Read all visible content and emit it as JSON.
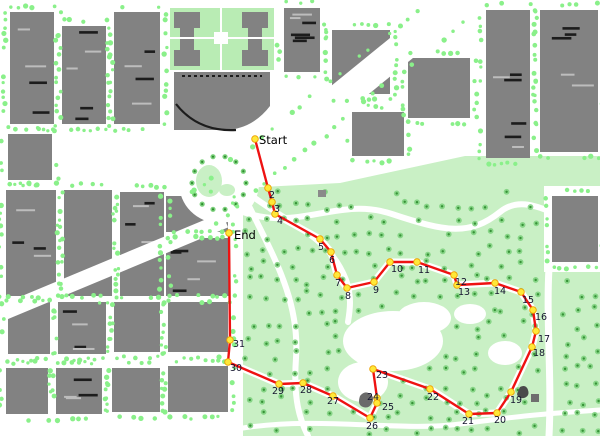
{
  "map": {
    "start_label": "Start",
    "end_label": "End",
    "colors": {
      "route": "#ee1212",
      "marker_fill": "#ffe838",
      "marker_stroke": "#eda000",
      "building": "#828282",
      "building_dark": "#1c1c1c",
      "roof_light": "#bdbdbd",
      "veg_dot": "#8af08a",
      "park": "#c9f0c5",
      "tree": "#7bd07b",
      "tree_core": "#2e8b2e",
      "road": "#ffffff",
      "label_color": "#14142e",
      "endpoint_label_color": "#000000"
    },
    "waypoints": [
      {
        "label": "Start",
        "x": 255,
        "y": 139,
        "dx": 4,
        "dy": 5,
        "big": true
      },
      {
        "label": "2",
        "x": 268,
        "y": 188,
        "dx": 1,
        "dy": 10
      },
      {
        "label": "3",
        "x": 272,
        "y": 202,
        "dx": 2,
        "dy": 10
      },
      {
        "label": "4",
        "x": 275,
        "y": 214,
        "dx": 2,
        "dy": 10
      },
      {
        "label": "5",
        "x": 320,
        "y": 239,
        "dx": -2,
        "dy": 11
      },
      {
        "label": "6",
        "x": 331,
        "y": 252,
        "dx": -2,
        "dy": 11
      },
      {
        "label": "7",
        "x": 337,
        "y": 275,
        "dx": -2,
        "dy": 11
      },
      {
        "label": "8",
        "x": 347,
        "y": 288,
        "dx": -2,
        "dy": 11
      },
      {
        "label": "9",
        "x": 374,
        "y": 282,
        "dx": -1,
        "dy": 11
      },
      {
        "label": "10",
        "x": 390,
        "y": 262,
        "dx": 1,
        "dy": 10
      },
      {
        "label": "11",
        "x": 417,
        "y": 262,
        "dx": 1,
        "dy": 11
      },
      {
        "label": "12",
        "x": 454,
        "y": 275,
        "dx": 1,
        "dy": 10
      },
      {
        "label": "13",
        "x": 457,
        "y": 285,
        "dx": 1,
        "dy": 10
      },
      {
        "label": "14",
        "x": 495,
        "y": 283,
        "dx": -1,
        "dy": 11
      },
      {
        "label": "15",
        "x": 521,
        "y": 292,
        "dx": 1,
        "dy": 11
      },
      {
        "label": "16",
        "x": 533,
        "y": 310,
        "dx": 2,
        "dy": 10
      },
      {
        "label": "17",
        "x": 536,
        "y": 331,
        "dx": 2,
        "dy": 11
      },
      {
        "label": "18",
        "x": 532,
        "y": 347,
        "dx": 1,
        "dy": 9
      },
      {
        "label": "19",
        "x": 511,
        "y": 392,
        "dx": -1,
        "dy": 11
      },
      {
        "label": "20",
        "x": 497,
        "y": 413,
        "dx": -3,
        "dy": 10
      },
      {
        "label": "21",
        "x": 469,
        "y": 414,
        "dx": -7,
        "dy": 10
      },
      {
        "label": "22",
        "x": 430,
        "y": 389,
        "dx": -3,
        "dy": 11
      },
      {
        "label": "23",
        "x": 373,
        "y": 369,
        "dx": 3,
        "dy": 9
      },
      {
        "label": "24",
        "x": 377,
        "y": 398,
        "dx": -10,
        "dy": 2
      },
      {
        "label": "25",
        "x": 377,
        "y": 403,
        "dx": 5,
        "dy": 7
      },
      {
        "label": "26",
        "x": 370,
        "y": 418,
        "dx": -4,
        "dy": 11
      },
      {
        "label": "27",
        "x": 333,
        "y": 396,
        "dx": -6,
        "dy": 8
      },
      {
        "label": "28",
        "x": 303,
        "y": 383,
        "dx": -3,
        "dy": 10
      },
      {
        "label": "29",
        "x": 279,
        "y": 384,
        "dx": -7,
        "dy": 10
      },
      {
        "label": "30",
        "x": 228,
        "y": 362,
        "dx": 2,
        "dy": 9
      },
      {
        "label": "31",
        "x": 230,
        "y": 340,
        "dx": 3,
        "dy": 7
      },
      {
        "label": "End",
        "x": 229,
        "y": 233,
        "dx": 5,
        "dy": 6,
        "big": true
      }
    ]
  }
}
